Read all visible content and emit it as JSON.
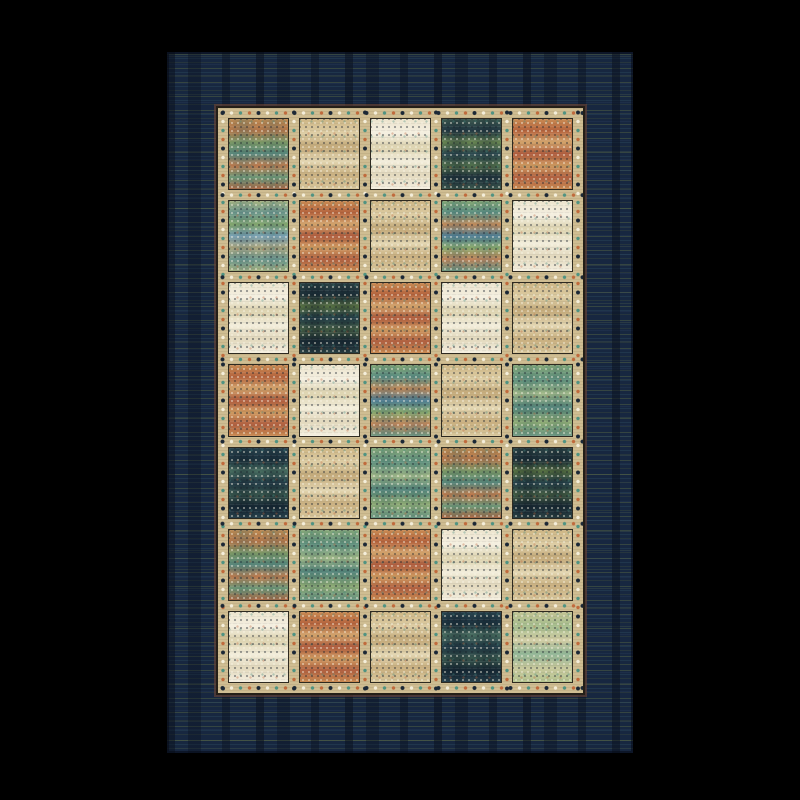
{
  "scene": {
    "type": "product-photo",
    "subject": "patchwork quilt-style area rug",
    "background_color": "#000000"
  },
  "rug": {
    "border_field": {
      "base_color": "#172740",
      "streak_colors": [
        "#7a8a44",
        "#3a606e",
        "#96a65a",
        "#2c405e"
      ]
    },
    "frame": {
      "sash_color": "#cfbd92",
      "outline_color": "#241f18",
      "maroon_trim_color": "rgba(110,68,52,0.6)",
      "patch_outline_color": "#2e2a20",
      "motif_dot_colors": {
        "navy": "#1b2836",
        "cream": "#f4eeda",
        "teal": "#4f9382",
        "orange": "#c06a3c"
      }
    },
    "grid": {
      "rows": 7,
      "columns": 5
    },
    "patch_types": {
      "orange": {
        "label": "rust orange striped",
        "bands": [
          "#c98a52",
          "#b5643e",
          "#d2a36b",
          "#ad5a3c",
          "#cf9a60",
          "#b06040",
          "#c98a52"
        ]
      },
      "orange-multi": {
        "label": "orange with teal plaid bands",
        "bands": [
          "#c08a50",
          "#b5764a",
          "#7d9a66",
          "#58877c",
          "#c77d4e",
          "#6f9a78",
          "#b06844"
        ],
        "cross": [
          "rgba(70,110,100,0)",
          "rgba(70,110,100,0.32)",
          "rgba(70,110,100,0)",
          "rgba(70,110,100,0.28)",
          "rgba(70,110,100,0)"
        ]
      },
      "tan": {
        "label": "tan beige streaked",
        "bands": [
          "#cdb584",
          "#ddcda4",
          "#c2a878",
          "#e2d5b0",
          "#c8ae7e",
          "#d8c79c"
        ]
      },
      "cream": {
        "label": "cream white speckled",
        "bands": [
          "#ece4cd",
          "#f4efe0",
          "#dcd2ae",
          "#f2edda",
          "#e2d8bc",
          "#f4efe0"
        ]
      },
      "teal-light": {
        "label": "light teal and olive plaid",
        "bands": [
          "#a9b581",
          "#6f9a8e",
          "#85a86c",
          "#7aa2b5",
          "#b0a87e",
          "#6f9a8e",
          "#a9b581"
        ],
        "cross": [
          "rgba(60,100,115,0)",
          "rgba(60,100,115,0.25)",
          "rgba(60,100,115,0)",
          "rgba(60,100,115,0.25)",
          "rgba(60,100,115,0)"
        ]
      },
      "teal-multi": {
        "label": "green teal with orange bands",
        "bands": [
          "#86a873",
          "#5f9384",
          "#c78d5a",
          "#4f7f96",
          "#8fae6e",
          "#c2855a",
          "#6f9a82"
        ],
        "cross": [
          "rgba(50,90,105,0)",
          "rgba(50,90,105,0.25)",
          "rgba(50,90,105,0)",
          "rgba(50,90,105,0.22)",
          "rgba(50,90,105,0)"
        ]
      },
      "teal-dark": {
        "label": "dark teal green plaid",
        "bands": [
          "#3d5a50",
          "#243a44",
          "#6c8a54",
          "#2b4850",
          "#55744e",
          "#1f323c",
          "#3d5a50"
        ],
        "cross": [
          "rgba(15,30,40,0)",
          "rgba(15,30,40,0.35)",
          "rgba(15,30,40,0)",
          "rgba(15,30,40,0.3)",
          "rgba(15,30,40,0)"
        ]
      },
      "navy-dark": {
        "label": "dark navy olive plaid",
        "bands": [
          "#2c4446",
          "#1d3039",
          "#5a7444",
          "#24404a",
          "#455e44",
          "#192a34",
          "#2c4446"
        ],
        "cross": [
          "rgba(10,22,32,0)",
          "rgba(10,22,32,0.35)",
          "rgba(10,22,32,0)",
          "rgba(10,22,32,0.3)",
          "rgba(10,22,32,0)"
        ]
      },
      "navy-teal": {
        "label": "dark navy teal plaid",
        "bands": [
          "#2a4550",
          "#1c323e",
          "#4a7062",
          "#233c48",
          "#39584e",
          "#162834",
          "#2a4550"
        ],
        "cross": [
          "rgba(12,25,35,0)",
          "rgba(12,25,35,0.35)",
          "rgba(12,25,35,0)",
          "rgba(12,25,35,0.3)",
          "rgba(12,25,35,0)"
        ]
      },
      "teal-green": {
        "label": "medium green teal plaid",
        "bands": [
          "#8aab7a",
          "#62937f",
          "#a2b988",
          "#54857b",
          "#90ac74",
          "#6f9a85"
        ],
        "cross": [
          "rgba(55,100,95,0)",
          "rgba(55,100,95,0.25)",
          "rgba(55,100,95,0)",
          "rgba(55,100,95,0.22)",
          "rgba(55,100,95,0)"
        ]
      },
      "green-light": {
        "label": "pale green with beige",
        "bands": [
          "#c2c494",
          "#a5bd8d",
          "#d2cda4",
          "#8fb494",
          "#c8c89c",
          "#b4c490"
        ]
      }
    },
    "patch_map": [
      [
        "orange-multi",
        "tan",
        "cream",
        "teal-dark",
        "orange"
      ],
      [
        "teal-light",
        "orange",
        "tan",
        "teal-multi",
        "cream"
      ],
      [
        "cream",
        "navy-dark",
        "orange",
        "cream",
        "tan"
      ],
      [
        "orange",
        "cream",
        "teal-multi",
        "tan",
        "teal-green"
      ],
      [
        "navy-teal",
        "tan",
        "teal-green",
        "orange-multi",
        "navy-dark"
      ],
      [
        "orange-multi",
        "teal-green",
        "orange",
        "cream",
        "tan"
      ],
      [
        "cream",
        "orange",
        "tan",
        "navy-teal",
        "green-light"
      ]
    ]
  }
}
